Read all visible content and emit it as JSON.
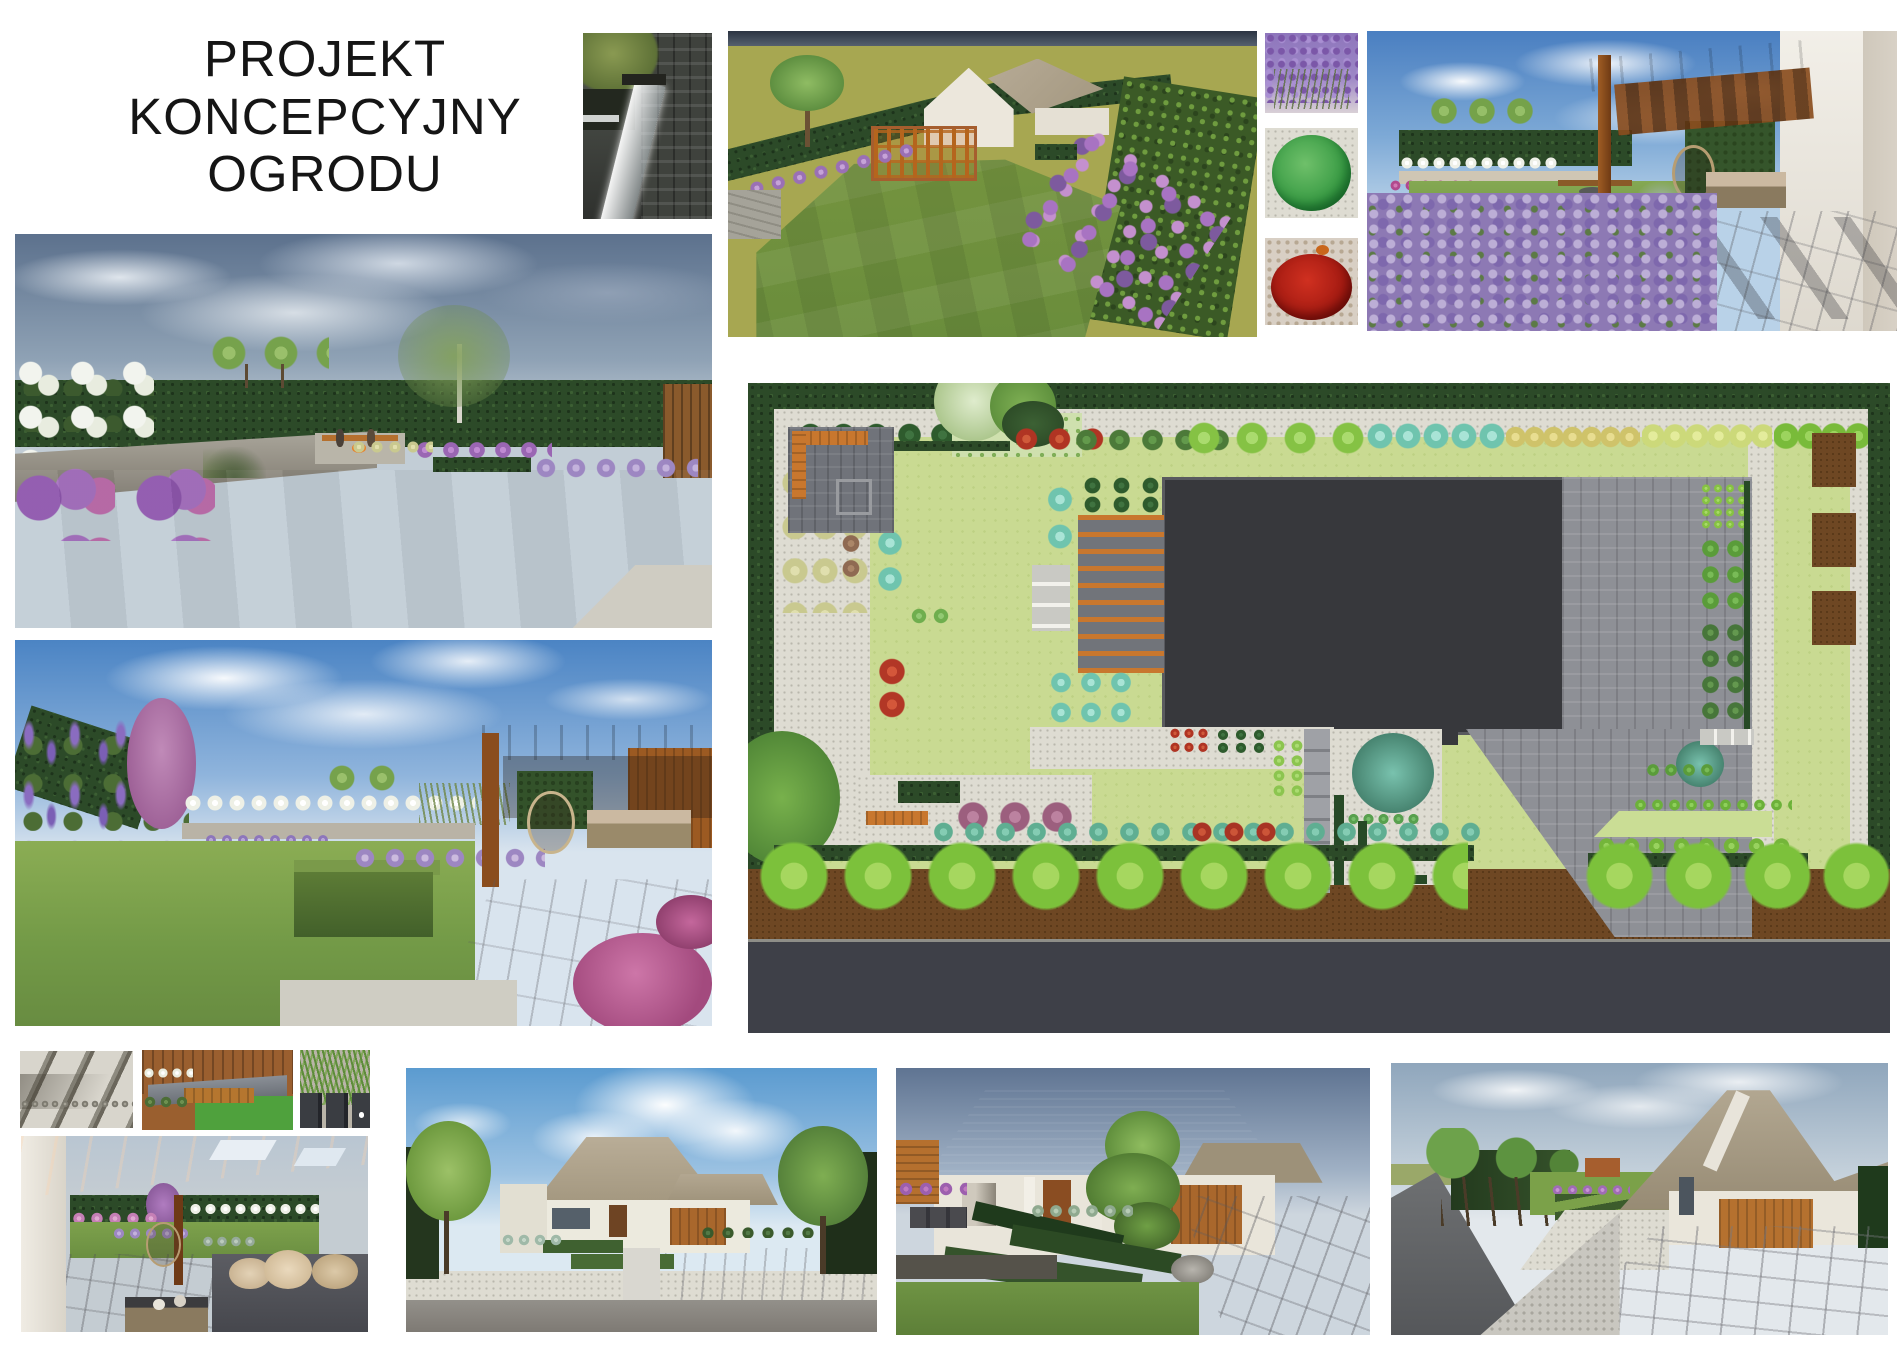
{
  "title": {
    "lines": [
      "PROJEKT",
      "KONCEPCYJNY",
      "OGRODU"
    ]
  },
  "panels": {
    "waterfall": {
      "desc": "Kamienna sciana z wodospadem"
    },
    "aerial": {
      "desc": "Wizualizacja ogrodu - widok z lotu ptaka"
    },
    "swatch_lavender": {
      "desc": "Lawenda"
    },
    "swatch_boxwood": {
      "desc": "Bukszpan kulisty"
    },
    "swatch_red": {
      "desc": "Berberys czerwony"
    },
    "terrace": {
      "desc": "Pergola przy tarasie z lawenda"
    },
    "garden_firepit": {
      "desc": "Ogrod z paleniskiem i lawka"
    },
    "garden_pergola": {
      "desc": "Ogrod z pergola i bylinami"
    },
    "plan": {
      "desc": "Rzut koncepcyjny ogrodu"
    },
    "steps": {
      "desc": "Stopnie kamienne"
    },
    "bench": {
      "desc": "Lawka drewniana przy donicach"
    },
    "grasses": {
      "desc": "Trawy ozdobne w donicach"
    },
    "pergola_seating": {
      "desc": "Strefa wypoczynkowa pod pergola"
    },
    "house_front": {
      "desc": "Dom - widok od frontu"
    },
    "house_drive": {
      "desc": "Podjazd i ogrod frontowy"
    },
    "street": {
      "desc": "Widok od ulicy"
    }
  },
  "colors": {
    "accent_wood": "#c8772e",
    "plan_lawn": "#c9da92",
    "hedge": "#2c4a28",
    "house_footprint": "#37383c",
    "road": "#3e4048",
    "gravel": "#dedcd2",
    "teal_plant": "#5fae92",
    "red_plant": "#b23423",
    "purple_plant": "#8f68bf",
    "tree_green": "#7cc13b"
  }
}
